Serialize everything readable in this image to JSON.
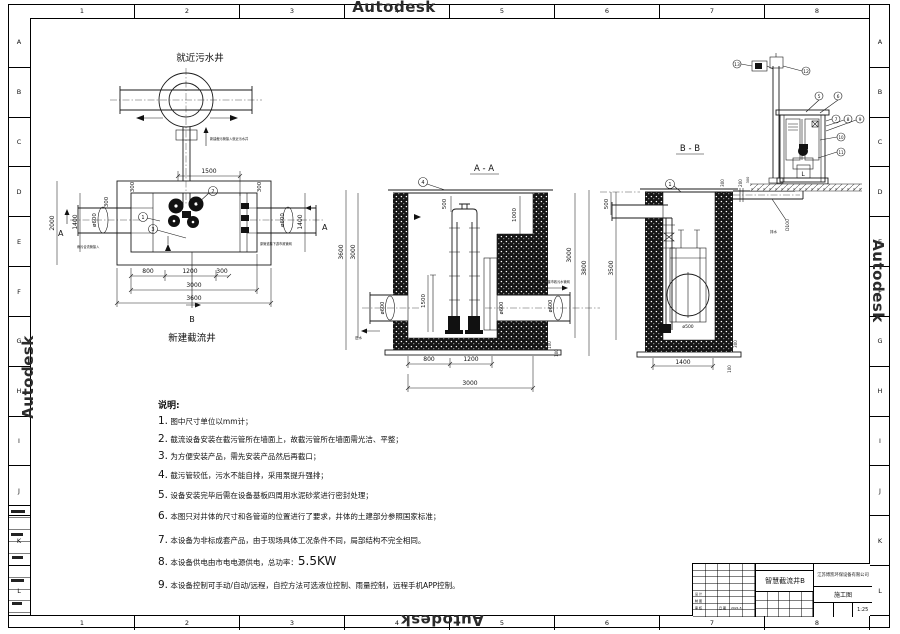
{
  "watermark": "Autodesk",
  "frame": {
    "cols": [
      "1",
      "2",
      "3",
      "4",
      "5",
      "6",
      "7",
      "8"
    ],
    "rows": [
      "A",
      "B",
      "C",
      "D",
      "E",
      "F",
      "G",
      "H",
      "I",
      "J",
      "K",
      "L"
    ]
  },
  "plan": {
    "well_label": "就近污水井",
    "caption": "新建截流井",
    "marker_b": "B",
    "marker_a_right": "A",
    "marker_a_left": "A",
    "note_top": "新建截污管接入就近污水井",
    "note_left": "雨污合流管接入",
    "note_right": "原管道接下游市政管网",
    "callouts": {
      "c1": "1",
      "c2": "2",
      "c3": "3"
    },
    "dims": {
      "d1500": "1500",
      "d300tl": "300",
      "d300tr": "300",
      "d300l": "300",
      "d2000": "2000",
      "d1400l": "1400",
      "d600l": "ø600",
      "d600r": "ø600",
      "d1400r": "1400",
      "d800": "800",
      "d1200": "1200",
      "d300b": "300",
      "d3000": "3000",
      "d3600": "3600"
    }
  },
  "section_aa": {
    "title": "A - A",
    "callout": "4",
    "note_in": "进水",
    "note_out": "排水管接市政污水管网",
    "dims": {
      "d500": "500",
      "d1000": "1000",
      "d3600": "3600",
      "d3000l": "3000",
      "d3000r": "3000",
      "d3800": "3800",
      "d1500": "1500",
      "d600l": "ø600",
      "d600m": "ø600",
      "d600r": "ø600",
      "d800": "800",
      "d1200": "1200",
      "d3000b": "3000",
      "d100a": "100",
      "d100b": "100"
    }
  },
  "section_bb": {
    "title": "B - B",
    "callout": "1",
    "valve": "ø500",
    "pipe_label": "D100",
    "pipe_note": "排水",
    "dims": {
      "d500": "500",
      "d3500": "3500",
      "d1400": "1400",
      "d100": "100",
      "d300r": "300",
      "d300p": "300",
      "d200p": "200"
    }
  },
  "cabinet": {
    "l_label": "L",
    "dim300": "300",
    "callouts": {
      "c5": "5",
      "c6": "6",
      "c7": "7",
      "c8": "8",
      "c9": "9",
      "c10": "10",
      "c11": "11",
      "c12": "12",
      "c13": "13"
    }
  },
  "notes": {
    "heading": "说明:",
    "items": [
      {
        "n": "1.",
        "t": "图中尺寸单位以mm计；",
        "big": ""
      },
      {
        "n": "2.",
        "t": "截流设备安装在截污管所在墙面上，故截污管所在墙面需光洁、平整；",
        "big": ""
      },
      {
        "n": "3.",
        "t": "为方便安装产品，需先安装产品然后再截口；",
        "big": ""
      },
      {
        "n": "4.",
        "t": "截污管较低，污水不能自排，采用泵提升强排；",
        "big": ""
      },
      {
        "n": "5.",
        "t": "设备安装完毕后需在设备基板四周用水泥砂浆进行密封处理；",
        "big": ""
      },
      {
        "n": "6.",
        "t": "本图只对井体的尺寸和各管道的位置进行了要求，井体的土建部分参照国家标准；",
        "big": ""
      },
      {
        "n": "7.",
        "t": "本设备为非标成套产品，由于现场具体工况条件不同，局部结构不完全相同。",
        "big": ""
      },
      {
        "n": "8.",
        "t": "本设备供电由市电电源供电，总功率：",
        "big": "5.5KW"
      },
      {
        "n": "9.",
        "t": "本设备控制可手动/自动/远程，自控方法可选液位控制、雨量控制，远程手机APP控制。",
        "big": ""
      }
    ]
  },
  "titleblock": {
    "title": "智慧截流井B",
    "company": "江苏博凯环保设备有限公司",
    "stage": "施工图",
    "scale": "1:25",
    "fields": {
      "f1": "设 计",
      "f2": "制 图",
      "f3": "审 核",
      "f4": "日 期",
      "f5": "2021.5"
    }
  }
}
